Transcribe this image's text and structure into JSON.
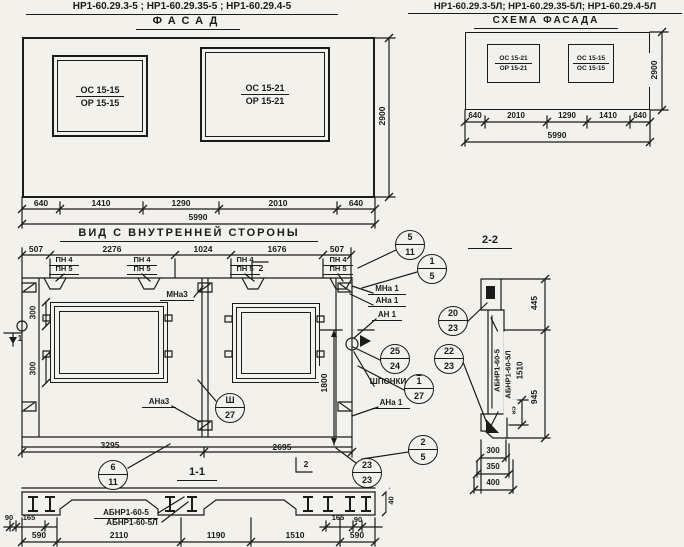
{
  "header_left": {
    "title": "НР1-60.29.3-5 ; НР1-60.29.35-5 ; НР1-60.29.4-5",
    "subtitle": "ФАСАД"
  },
  "header_right": {
    "title": "НР1-60.29.3-5Л; НР1-60.29.35-5Л; НР1-60.29.4-5Л",
    "subtitle": "СХЕМА ФАСАДА"
  },
  "facade": {
    "window1": {
      "line1": "ОС 15-15",
      "line2": "ОР 15-15"
    },
    "window2": {
      "line1": "ОС 15-21",
      "line2": "ОР 15-21"
    },
    "height": "2900",
    "dims": [
      "640",
      "1410",
      "1290",
      "2010",
      "640"
    ],
    "total": "5990"
  },
  "scheme": {
    "window1": {
      "line1": "ОС 15-21",
      "line2": "ОР 15-21"
    },
    "window2": {
      "line1": "ОС 15-15",
      "line2": "ОС 15-15"
    },
    "height": "2900",
    "dims": [
      "640",
      "2010",
      "1290",
      "1410",
      "640"
    ],
    "total": "5990"
  },
  "interior": {
    "title": "ВИД С ВНУТРЕННЕЙ СТОРОНЫ",
    "top_dims": [
      "507",
      "2276",
      "1024",
      "1676",
      "507"
    ],
    "pn1": "ПН 4",
    "pn2": "ПН 5",
    "sec_flag_top": "2",
    "sec_flag_bottom": "2",
    "sec_flag_left": "1",
    "dim_300": "300",
    "dim_1800": "1800",
    "dim_3295": "3295",
    "dim_2695": "2695",
    "labels": {
      "mna3": "МНа3",
      "ana3": "АНа3",
      "mna1": "МНа 1",
      "ana1": "АНа 1",
      "an1": "АН 1",
      "shponki": "ШПОНКИ",
      "ana1b": "АНа 1"
    },
    "section_mark": "1-1"
  },
  "circles": {
    "c5_11": {
      "top": "5",
      "bottom": "11"
    },
    "c1_5": {
      "top": "1",
      "bottom": "5"
    },
    "cIII_27": {
      "top": "Ш",
      "bottom": "27"
    },
    "c25_24": {
      "top": "25",
      "bottom": "24"
    },
    "c1_27": {
      "top": "1",
      "bottom": "27"
    },
    "c6_11": {
      "top": "6",
      "bottom": "11"
    },
    "c23_23": {
      "top": "23",
      "bottom": "23"
    },
    "c2_5": {
      "top": "2",
      "bottom": "5"
    },
    "c20_23": {
      "top": "20",
      "bottom": "23"
    },
    "c22_23": {
      "top": "22",
      "bottom": "23"
    }
  },
  "section11": {
    "label1": "АБНР1-60-5",
    "label2": "АБНР1-60-5Л",
    "dims_left": [
      "90",
      "165"
    ],
    "dims_main": [
      "590",
      "2110",
      "1190",
      "1510",
      "590"
    ],
    "dims_right": [
      "165",
      "90"
    ],
    "dim_40": "40"
  },
  "section22": {
    "title": "2-2",
    "dim_445": "445",
    "dim_945": "945",
    "dim_95": "95",
    "dims_bottom": [
      "300",
      "350",
      "400"
    ],
    "rot_label1": "АБНР1-60-5",
    "rot_label2": "АБНР1-60-5Л",
    "rot_dim": "1510"
  }
}
